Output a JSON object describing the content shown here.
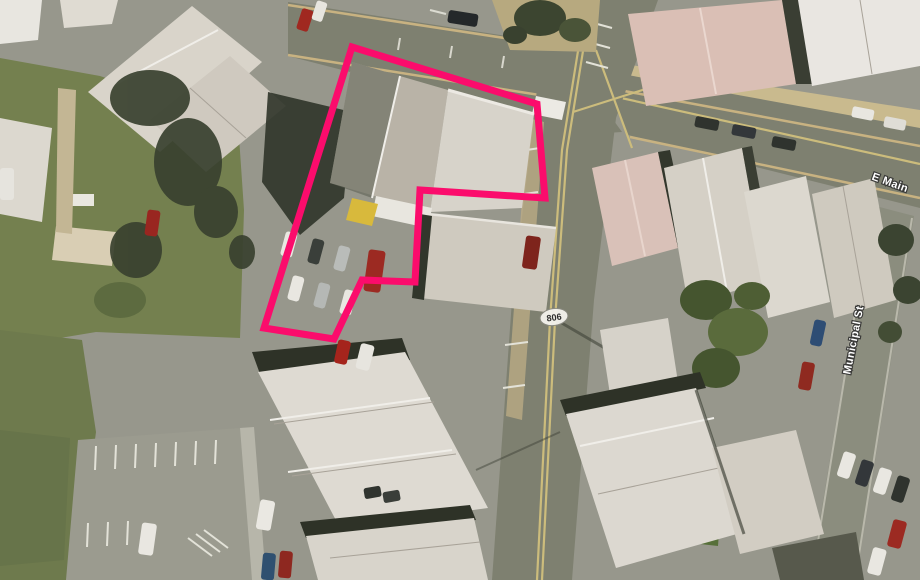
{
  "map": {
    "street_labels": [
      {
        "id": "e-main",
        "text": "E Main"
      },
      {
        "id": "municipal",
        "text": "Municipal St"
      }
    ],
    "route_shield": {
      "text": "806"
    },
    "parcel_outline": {
      "color": "#fb0c6c",
      "stroke_width": "7",
      "points": "352,47 537,104 545,198 420,190 415,282 362,280 334,339 264,328"
    },
    "palette": {
      "pavement": "#97978c",
      "road": "#7e8070",
      "grass": "#74804f",
      "lane_yellow": "#ccbc7c",
      "curb_tan": "#c8b281",
      "roof_light": "#dedad2",
      "roof_white": "#e9e6e1",
      "roof_gray": "#c9c4b9",
      "roof_pink": "#d9c1b8",
      "shadow": "#2e3227",
      "tree": "#3b4431"
    }
  }
}
